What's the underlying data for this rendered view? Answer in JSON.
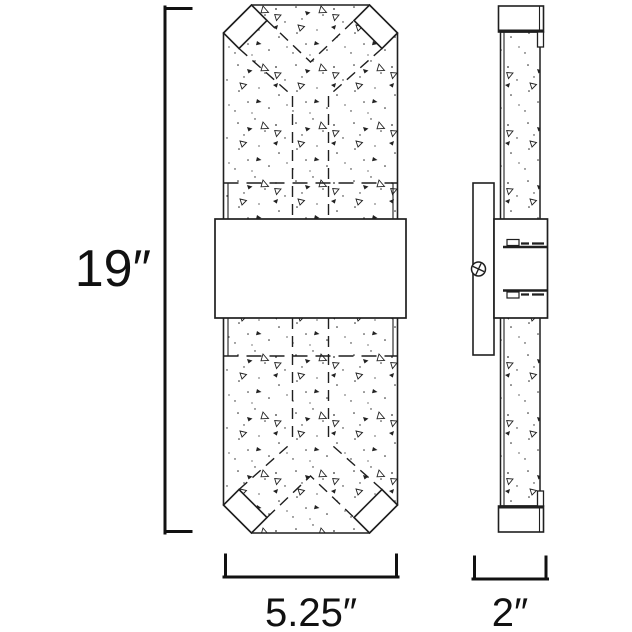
{
  "dimensions": {
    "height": {
      "label": "19″"
    },
    "width": {
      "label": "5.25″"
    },
    "depth": {
      "label": "2″"
    }
  },
  "colors": {
    "line": "#1f1f1f",
    "dimension": "#111111",
    "background": "#ffffff"
  }
}
